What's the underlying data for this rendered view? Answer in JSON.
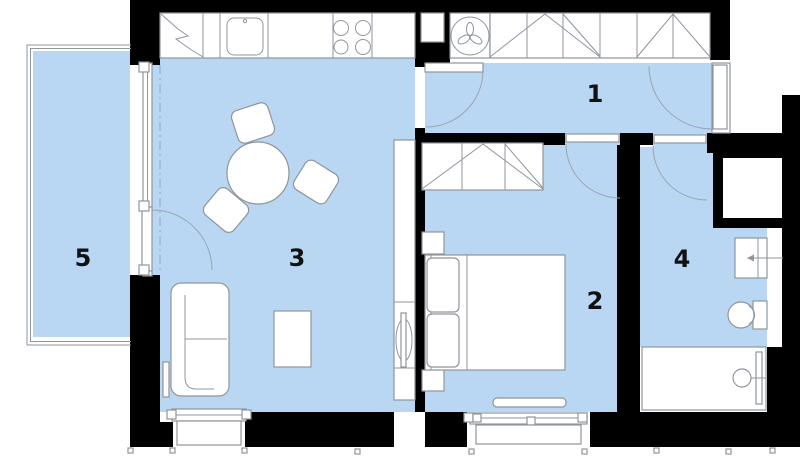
{
  "colors": {
    "floor": "#b9d7f2",
    "wall": "#000000",
    "line": "#8f959c",
    "label": "#111111"
  },
  "rooms": {
    "hallway": {
      "label": "1"
    },
    "bedroom": {
      "label": "2"
    },
    "living_room": {
      "label": "3"
    },
    "bathroom": {
      "label": "4"
    },
    "balcony": {
      "label": "5"
    }
  }
}
